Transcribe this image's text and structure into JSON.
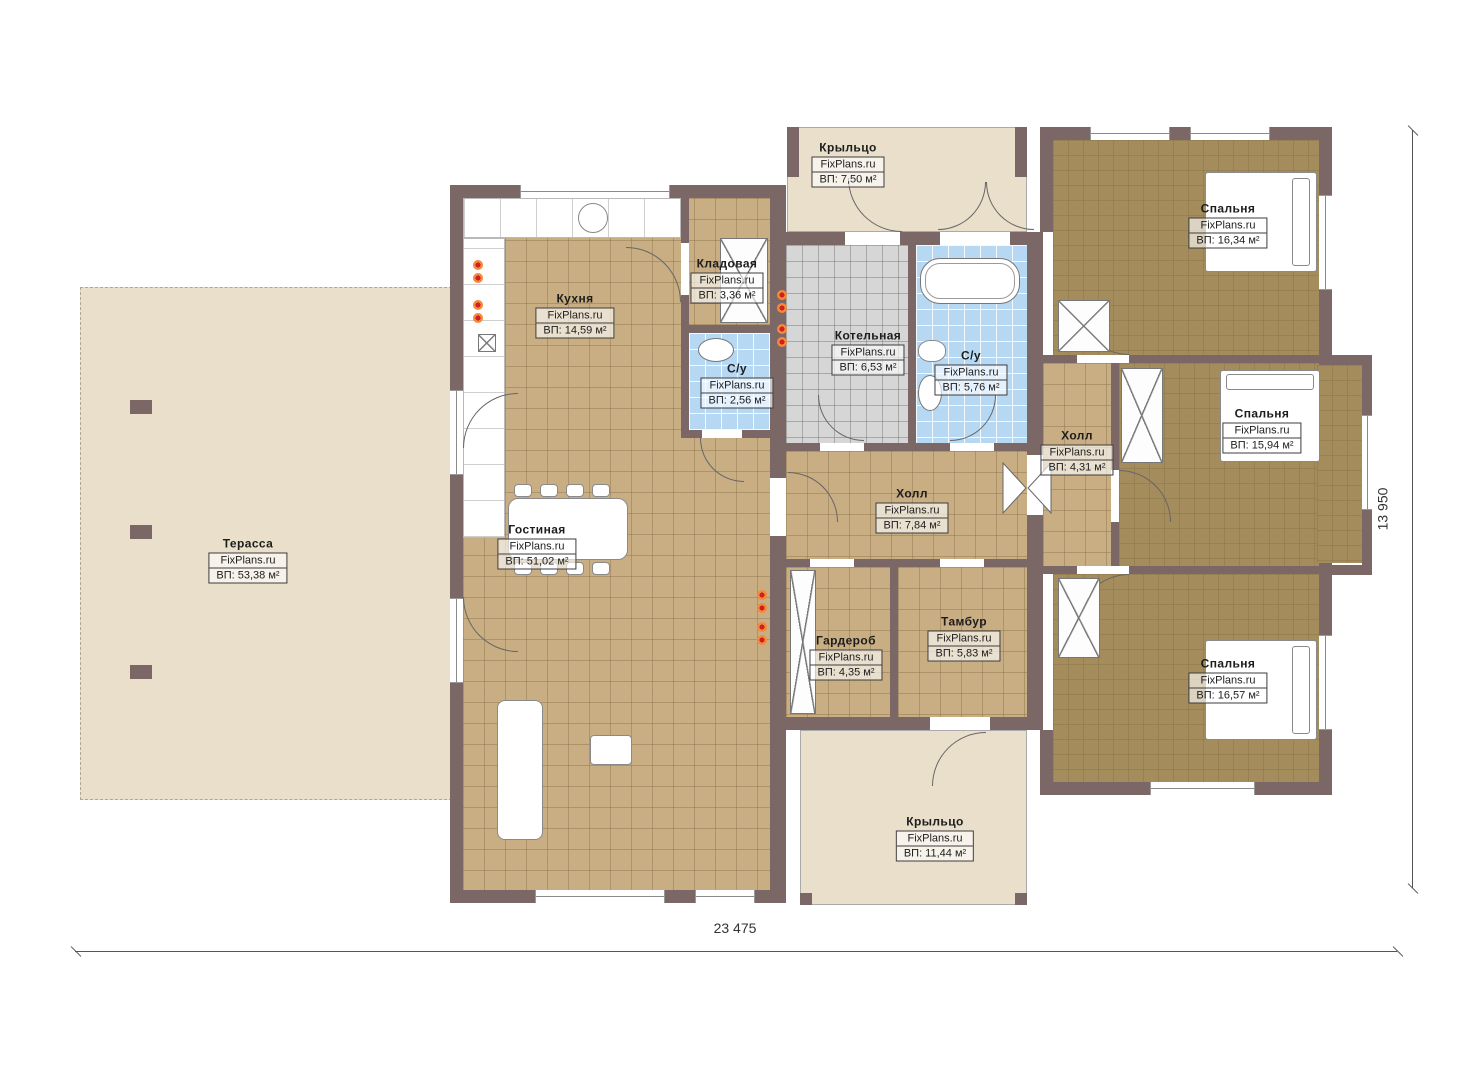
{
  "dimensions": {
    "width_label": "23 475",
    "height_label": "13 950"
  },
  "rooms": [
    {
      "key": "terrace",
      "name": "Терасса",
      "site": "FixPlans.ru",
      "area": "ВП: 53,38 м²"
    },
    {
      "key": "kitchen",
      "name": "Кухня",
      "site": "FixPlans.ru",
      "area": "ВП: 14,59 м²"
    },
    {
      "key": "pantry",
      "name": "Кладовая",
      "site": "FixPlans.ru",
      "area": "ВП: 3,36 м²"
    },
    {
      "key": "wc-small",
      "name": "С/у",
      "site": "FixPlans.ru",
      "area": "ВП: 2,56 м²"
    },
    {
      "key": "boiler-room",
      "name": "Котельная",
      "site": "FixPlans.ru",
      "area": "ВП: 6,53 м²"
    },
    {
      "key": "bathroom",
      "name": "С/у",
      "site": "FixPlans.ru",
      "area": "ВП: 5,76 м²"
    },
    {
      "key": "hall-small",
      "name": "Холл",
      "site": "FixPlans.ru",
      "area": "ВП: 4,31 м²"
    },
    {
      "key": "bedroom-top",
      "name": "Спальня",
      "site": "FixPlans.ru",
      "area": "ВП: 16,34 м²"
    },
    {
      "key": "bedroom-middle",
      "name": "Спальня",
      "site": "FixPlans.ru",
      "area": "ВП: 15,94 м²"
    },
    {
      "key": "bedroom-bottom",
      "name": "Спальня",
      "site": "FixPlans.ru",
      "area": "ВП: 16,57 м²"
    },
    {
      "key": "living-room",
      "name": "Гостиная",
      "site": "FixPlans.ru",
      "area": "ВП: 51,02 м²"
    },
    {
      "key": "hall-center",
      "name": "Холл",
      "site": "FixPlans.ru",
      "area": "ВП: 7,84 м²"
    },
    {
      "key": "wardrobe",
      "name": "Гардероб",
      "site": "FixPlans.ru",
      "area": "ВП: 4,35 м²"
    },
    {
      "key": "vestibule",
      "name": "Тамбур",
      "site": "FixPlans.ru",
      "area": "ВП: 5,83 м²"
    },
    {
      "key": "porch-top",
      "name": "Крыльцо",
      "site": "FixPlans.ru",
      "area": "ВП: 7,50 м²"
    },
    {
      "key": "porch-bottom",
      "name": "Крыльцо",
      "site": "FixPlans.ru",
      "area": "ВП: 11,44 м²"
    }
  ],
  "colors": {
    "wall": "#7c6767",
    "floor_tan": "#c9ae84",
    "floor_olive": "#a48c5c",
    "floor_blue": "#b7d8f3",
    "floor_gray": "#d6d6d6",
    "floor_beige": "#e9dfcb",
    "accent_orange": "#f5883a"
  }
}
